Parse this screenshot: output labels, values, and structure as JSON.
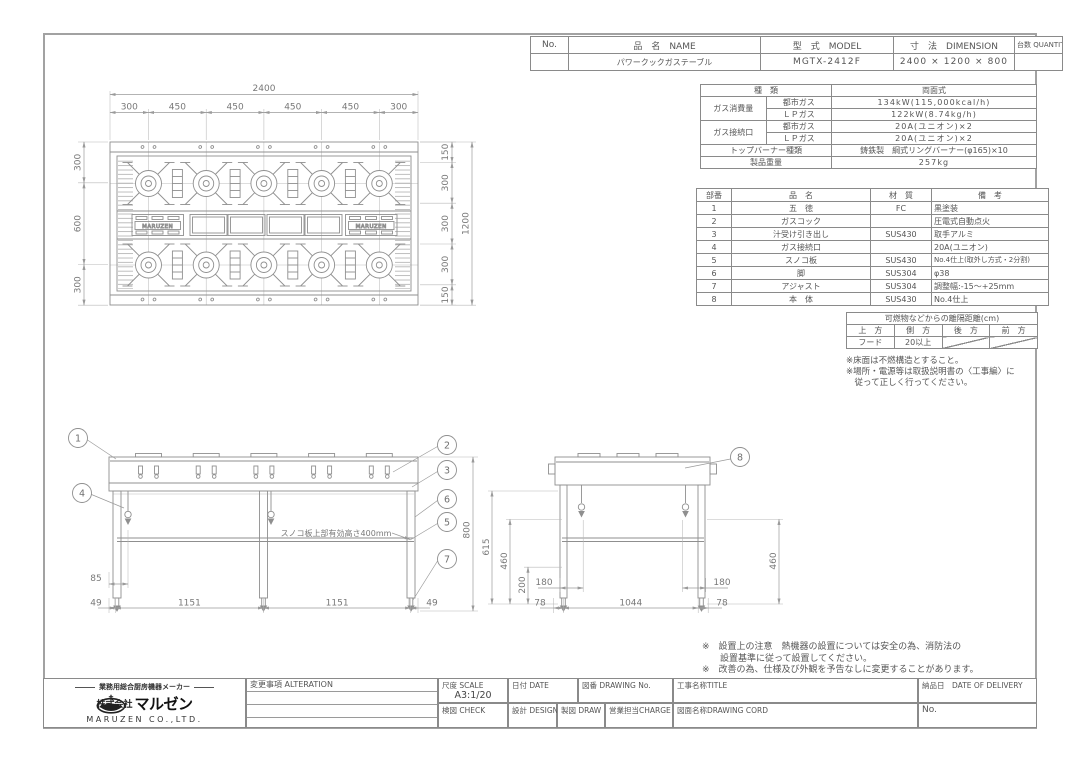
{
  "doc": {
    "header": {
      "col_no": "No.",
      "col_name": "品　名　NAME",
      "col_model": "型　式　MODEL",
      "col_dim": "寸　法　DIMENSION",
      "col_qty": "台数 QUANTITY",
      "name": "パワークックガステーブル",
      "model": "MGTX-2412F",
      "dimension": "2400 × 1200 × 800",
      "qty": ""
    },
    "spec": {
      "kind_label": "種　類",
      "kind_value": "両面式",
      "gas_label": "ガス消費量",
      "city_label": "都市ガス",
      "lp_label": "ＬＰガス",
      "city_value": "134kW(115,000kcal/h)",
      "lp_value": "122kW(8.74kg/h)",
      "conn_label": "ガス接続口",
      "conn_city_label": "都市ガス",
      "conn_lp_label": "ＬＰガス",
      "conn_city_value": "20A(ユニオン)×2",
      "conn_lp_value": "20A(ユニオン)×2",
      "burner_label": "トップバーナー種類",
      "burner_value": "鋳鉄製　綱式リングバーナー(φ165)×10",
      "weight_label": "製品重量",
      "weight_value": "257kg"
    },
    "parts": {
      "headers": {
        "no": "部番",
        "name": "品　名",
        "material": "材　質",
        "note": "備　考"
      },
      "rows": [
        {
          "no": "1",
          "name": "五　徳",
          "material": "FC",
          "note": "黒塗装"
        },
        {
          "no": "2",
          "name": "ガスコック",
          "material": "",
          "note": "圧電式自動点火"
        },
        {
          "no": "3",
          "name": "汁受け引き出し",
          "material": "SUS430",
          "note": "取手アルミ"
        },
        {
          "no": "4",
          "name": "ガス接続口",
          "material": "",
          "note": "20A(ユニオン)"
        },
        {
          "no": "5",
          "name": "スノコ板",
          "material": "SUS430",
          "note": "No.4仕上(取外し方式・2分割)"
        },
        {
          "no": "6",
          "name": "脚",
          "material": "SUS304",
          "note": "φ38"
        },
        {
          "no": "7",
          "name": "アジャスト",
          "material": "SUS304",
          "note": "調整幅:-15〜+25mm"
        },
        {
          "no": "8",
          "name": "本　体",
          "material": "SUS430",
          "note": "No.4仕上"
        }
      ]
    },
    "clearance": {
      "title": "可燃物などからの離隔距離(cm)",
      "headers": [
        "上　方",
        "側　方",
        "後　方",
        "前　方"
      ],
      "values": [
        "フード",
        "20以上"
      ],
      "notes": [
        "※床面は不燃構造とすること。",
        "※場所・電源等は取扱説明書の〈工事編〉に",
        "　従って正しく行ってください。"
      ]
    },
    "warnings": [
      "※　設置上の注意　熱機器の設置については安全の為、消防法の",
      "　　設置基準に従って設置してください。",
      "※　改善の為、仕様及び外観を予告なしに変更することがあります。"
    ],
    "plan": {
      "overall_width": "2400",
      "seg_labels": [
        "300",
        "450",
        "450",
        "450",
        "450",
        "300"
      ],
      "left_chain": [
        "300",
        "600",
        "300"
      ],
      "right_chain": [
        "150",
        "300",
        "300",
        "300",
        "150"
      ],
      "overall_depth": "1200",
      "brand": "MARUZEN"
    },
    "front": {
      "balloons": [
        "1",
        "2",
        "3",
        "4",
        "5",
        "6",
        "7"
      ],
      "dim_height": "800",
      "dim_85": "85",
      "bottom": [
        "49",
        "1151",
        "1151",
        "49"
      ],
      "shelf_note": "スノコ板上部有効高さ400mm"
    },
    "side": {
      "balloon": "8",
      "dim_615": "615",
      "dim_460l": "460",
      "dim_200": "200",
      "dim_460r": "460",
      "dim_180l": "180",
      "dim_180r": "180",
      "bottom": [
        "78",
        "1044",
        "78"
      ]
    },
    "titleblock": {
      "tagline": "業務用総合厨房機器メーカー",
      "company_prefix": "株式会社",
      "company_name": "マルゼン",
      "company_en": "MARUZEN CO.,LTD.",
      "alteration": "変更事項 ALTERATION",
      "scale_label": "尺度 SCALE",
      "scale_value": "A3:1/20",
      "date_label": "日付 DATE",
      "drawing_no_label": "図番 DRAWING No.",
      "title_label": "工事名称TITLE",
      "delivery_label": "納品日　DATE OF DELIVERY",
      "check_label": "検図 CHECK",
      "design_label": "設計 DESIGN",
      "draw_label": "製図 DRAW",
      "charge_label": "営業担当CHARGE",
      "cord_label": "図面名称DRAWING CORD",
      "no_label": "No."
    }
  }
}
